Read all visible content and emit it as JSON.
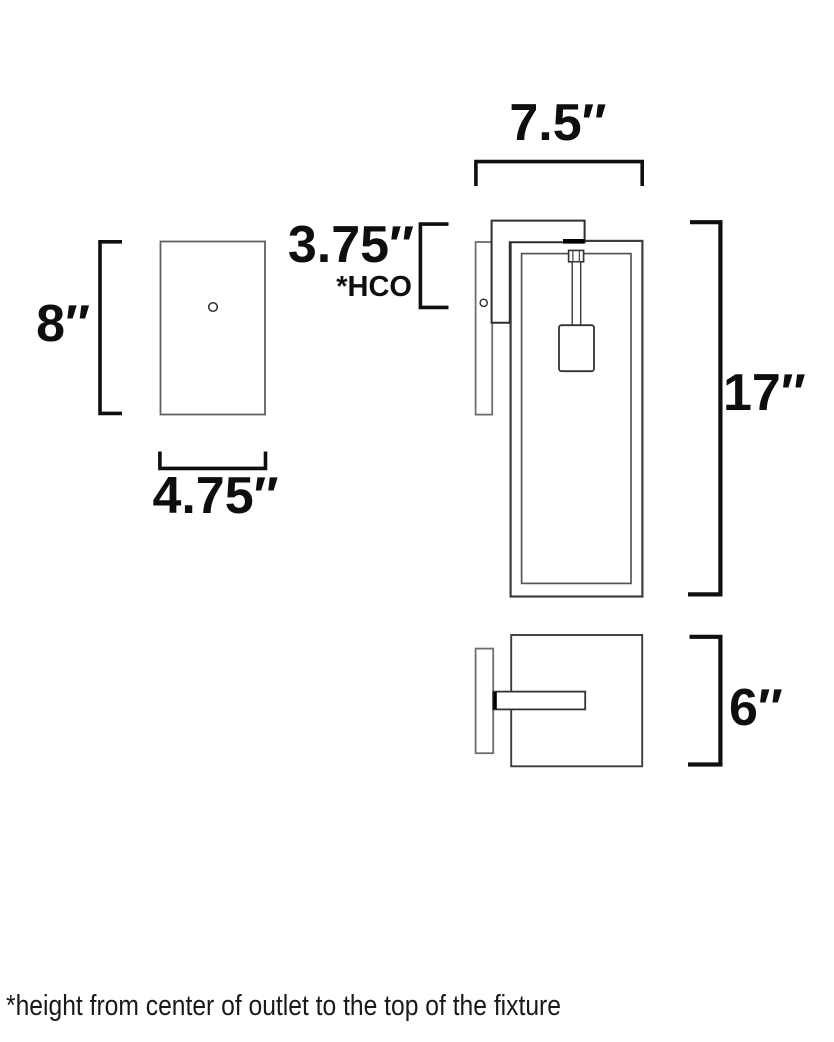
{
  "drawing": {
    "type": "dimension-diagram",
    "subject": "wall sconce fixture spec drawing",
    "labels": {
      "backplate_height": "8″",
      "backplate_width": "4.75″",
      "hco_value": "3.75″",
      "hco_note": "*HCO",
      "fixture_depth": "7.5″",
      "fixture_height": "17″",
      "fixture_width": "6″"
    },
    "footnote": "*height from center of outlet to the top of the fixture",
    "colors": {
      "background": "#ffffff",
      "bracket": "#0f0f0f",
      "outline_dark": "#3d3d3d",
      "outline_gray": "#6e6e6e",
      "text": "#0e0e0e"
    }
  }
}
